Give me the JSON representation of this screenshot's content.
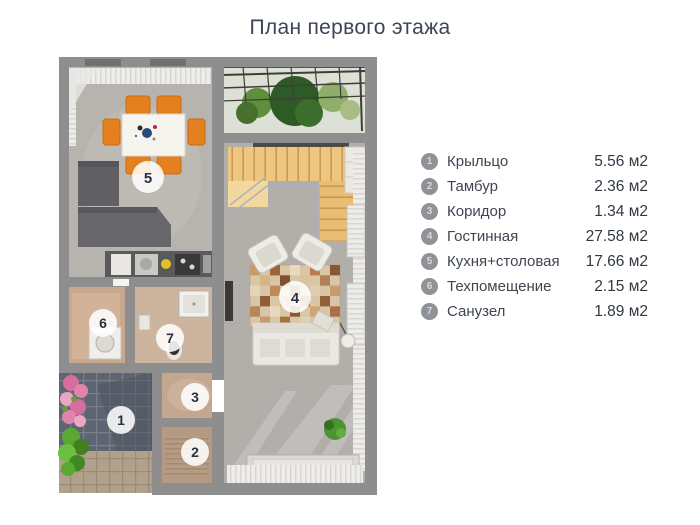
{
  "title": "План первого этажа",
  "legend": {
    "items": [
      {
        "num": "1",
        "label": "Крыльцо",
        "area": "5.56 м2"
      },
      {
        "num": "2",
        "label": "Тамбур",
        "area": "2.36 м2"
      },
      {
        "num": "3",
        "label": "Коридор",
        "area": "1.34 м2"
      },
      {
        "num": "4",
        "label": "Гостинная",
        "area": "27.58 м2"
      },
      {
        "num": "5",
        "label": "Кухня+столовая",
        "area": "17.66 м2"
      },
      {
        "num": "6",
        "label": "Техпомещение",
        "area": "2.15 м2"
      },
      {
        "num": "7",
        "label": "Санузел",
        "area": "1.89 м2"
      }
    ]
  },
  "plan": {
    "room_markers": [
      {
        "num": "1"
      },
      {
        "num": "2"
      },
      {
        "num": "3"
      },
      {
        "num": "4"
      },
      {
        "num": "5"
      },
      {
        "num": "6"
      },
      {
        "num": "7"
      }
    ],
    "colors": {
      "wall": "#8e8e8e",
      "floor": "#b4b1ac",
      "accent_orange": "#e5801f",
      "stair_wood": "#eec67f",
      "marker_bg": "#ffffff",
      "marker_text": "#2b3140",
      "porch_tile": "#5e6572",
      "plant_green": "#4c9432",
      "flower_pink": "#e183ad"
    }
  }
}
